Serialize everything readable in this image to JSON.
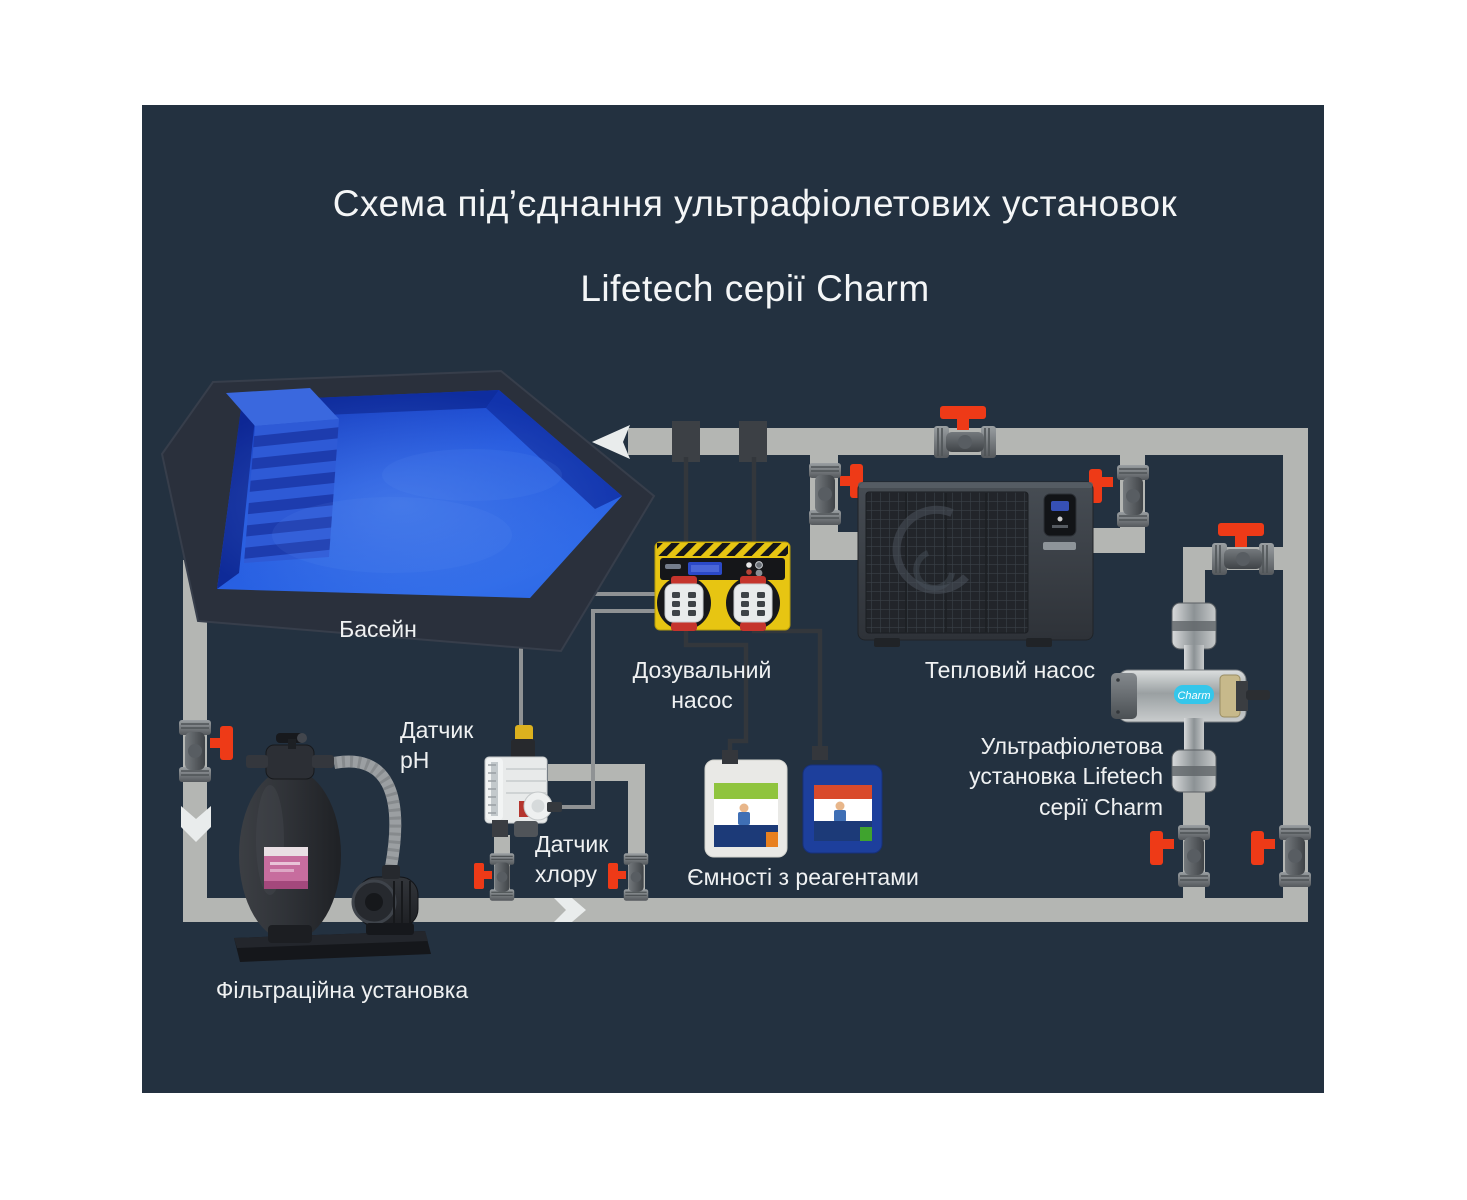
{
  "title": {
    "line1": "Схема під’єднання ультрафіолетових установок",
    "line2": "Lifetech серії Charm"
  },
  "labels": {
    "pool": "Басейн",
    "dosing_pump": "Дозувальний\nнасос",
    "heat_pump": "Тепловий насос",
    "ph_sensor": "Датчик\npH",
    "chlorine_sensor": "Датчик\nхлору",
    "reagent_tanks": "Ємності з реагентами",
    "uv_unit": "Ультрафіолетова\nустановка Lifetech\nсерії Charm",
    "filter_unit": "Фільтраційна установка",
    "uv_device_badge": "Charm"
  },
  "colors": {
    "page_bg": "#ffffff",
    "panel_bg": "#233140",
    "pipe_gray": "#b4b6b3",
    "valve_red": "#ee3a17",
    "dosing_pump_yellow": "#e7c512",
    "pool_water_blue": "#2257de",
    "label_text": "#eff1f2"
  }
}
